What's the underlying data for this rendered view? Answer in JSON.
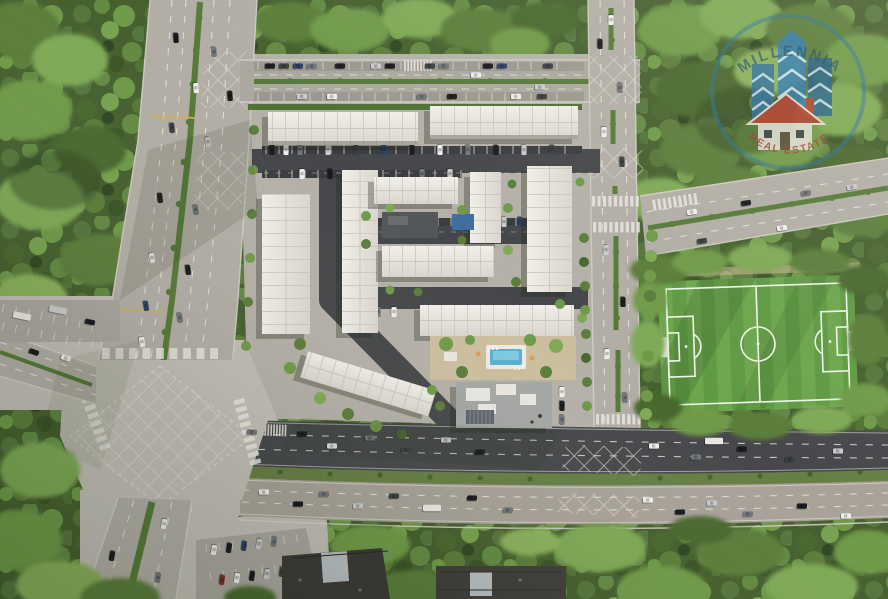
{
  "watermark": {
    "top": "MILLENNIA",
    "bottom": "REAL ESTATE",
    "ring_color": "#2d739e",
    "buildings_color": "#2a6d9c",
    "house_roof_color": "#b23c2c"
  },
  "colors": {
    "forest_base": "#46602f",
    "median_green": "#567a38",
    "road_light": "#b6b2aa",
    "road_mid": "#a49f96",
    "road_dark": "#46484b",
    "pavement_pale": "#c2beb6",
    "ground": "#b5b1a9",
    "sidewalk": "#d2cfc7",
    "marking_white": "#e9e6df",
    "marking_yellow": "#d2b052",
    "roof_line": "#c8c5bd",
    "dark_roof": "#3c3a37",
    "panel_gray": "#b8bec2",
    "field_dark": "#5f9a44",
    "field_light": "#6ca64d",
    "field_line": "#eef5e8",
    "pool_blue": "#58b1d0",
    "pool_blue_light": "#86cde3",
    "amenity_tan": "#cbbf9f",
    "clubhouse_gray": "#a4a7a5",
    "wm_blue_dark": "#1c4a68",
    "wm_red": "#a33528"
  }
}
